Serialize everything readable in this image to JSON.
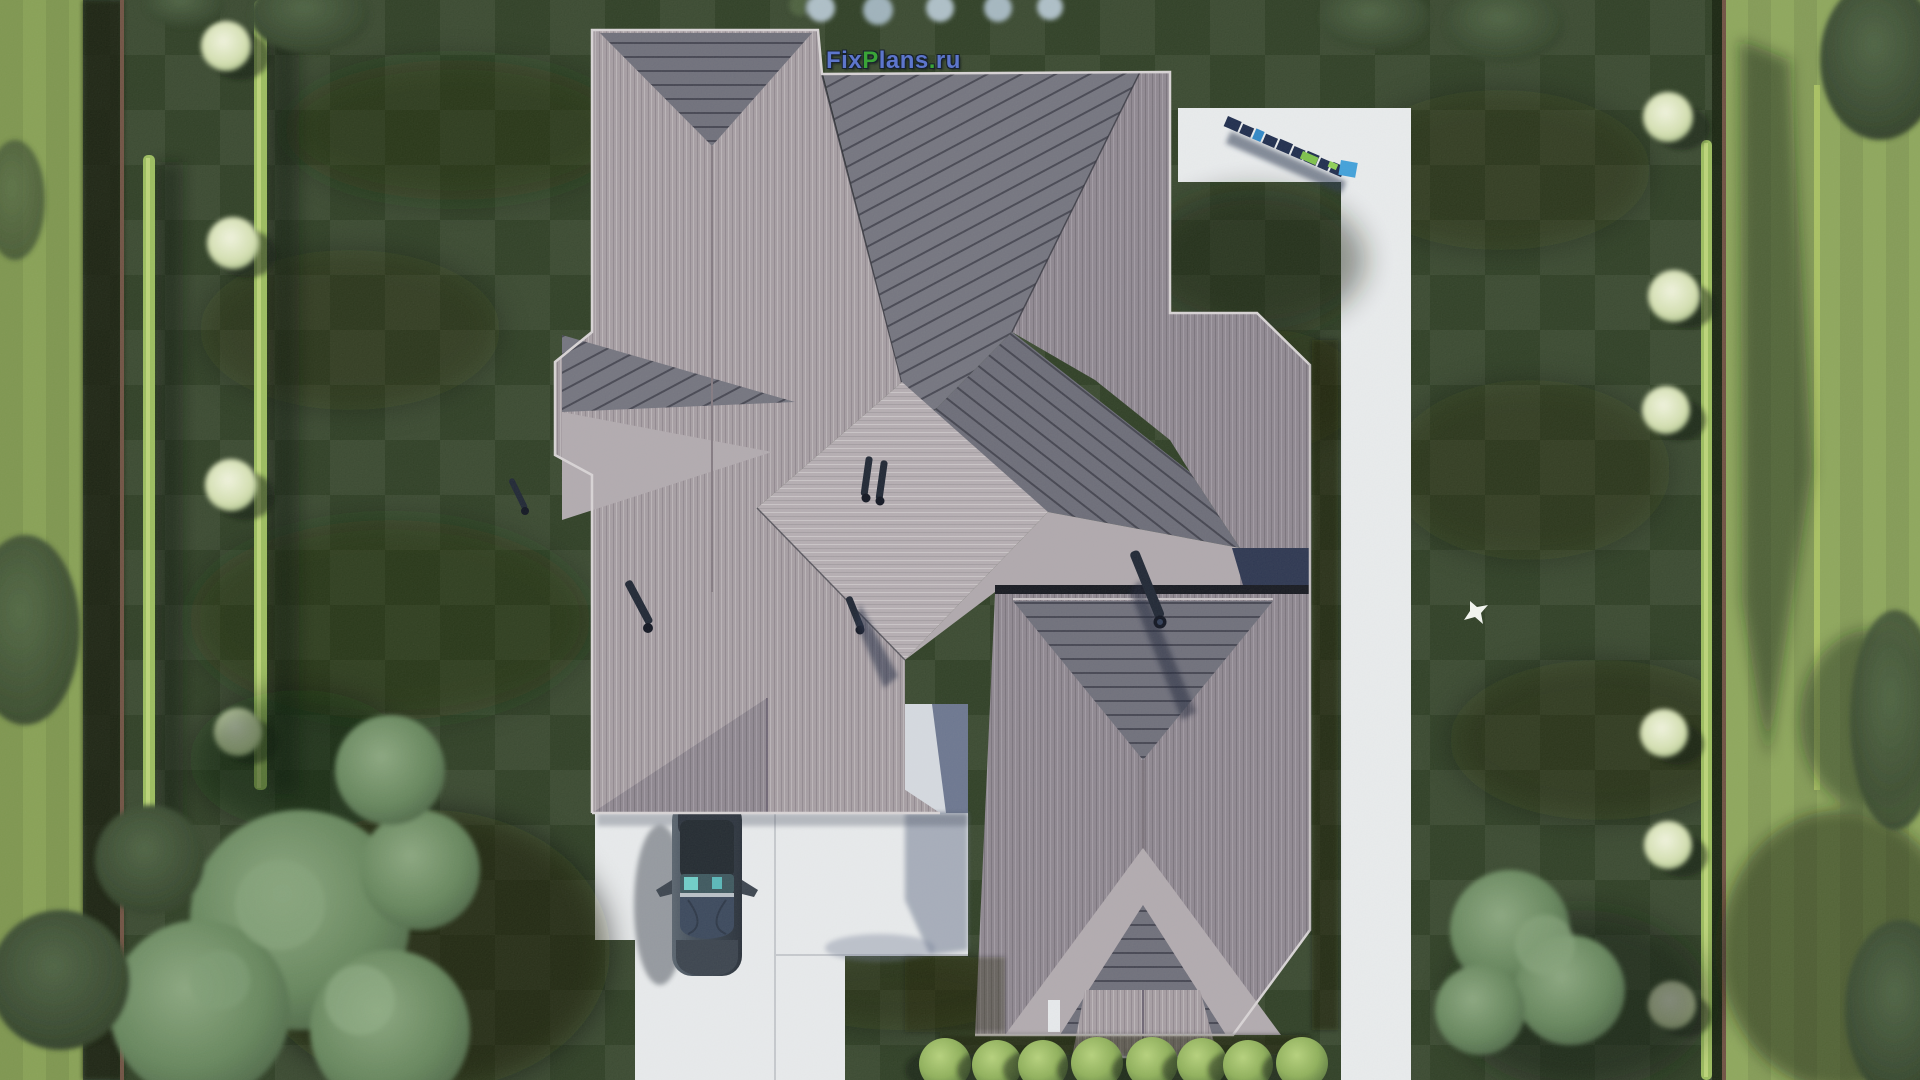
{
  "meta": {
    "type": "3d-aerial-architectural-render",
    "view": "top-down bird's-eye view of a house plot"
  },
  "watermark": {
    "parts": [
      {
        "text": "Fix",
        "color": "#5d76cc"
      },
      {
        "text": "P",
        "color": "#3aa437"
      },
      {
        "text": "lans",
        "color": "#5d76cc"
      },
      {
        "text": ".",
        "color": "#3aa437"
      },
      {
        "text": "ru",
        "color": "#5d76cc"
      }
    ],
    "outline_color": "#18222e"
  },
  "colors": {
    "lawn": "#2d3d24",
    "lawn_patch": "#16220f",
    "outer_strip_left": "#87a054",
    "outer_strip_right": "#8da65b",
    "hedge": "#9cbd5e",
    "fence": "#6f5042",
    "path": "#eaecef",
    "driveway": "#e9ebee",
    "courtyard_shadow": "#6b7590",
    "roof_light": "#a69da4",
    "roof_bright": "#b5adb3",
    "roof_medium": "#8e8691",
    "roof_dark": "#6e6e7b",
    "roof_fascia": "#d9d4d7",
    "roof_valley": "#2a2a36",
    "chimney": "#1d2433",
    "car_body": "#454f5e",
    "car_roof": "#20272f",
    "car_glass": "#66c4c4",
    "bush": "#9dbd63",
    "tree_canopy": "#5d7b55",
    "tree_white_top": "#eef2dd",
    "logo_block": "#1c2a4d",
    "logo_blue_cube": "#3fa0dc",
    "logo_green_bar": "#7dc14a",
    "bird": "#f4f6f2"
  },
  "scene": {
    "house": {
      "label": "gray hip-roof house seen from above",
      "sections": [
        "left wing with dark ridge triangle and garage gable",
        "top-right wing with diagonal-striped planes",
        "central bright hip cap with twin flue pipes",
        "bottom-right wing with striped triangle, chevron eaves and porch hip"
      ],
      "chimney_count": 5
    },
    "car": {
      "label": "dark SUV parked on driveway under garage eave",
      "heading": "south"
    },
    "walkway": {
      "label": "L-shaped white concrete walkway on the right",
      "logo_blocks_label": "row of 3D letter blocks with blue and green cubes casting shadows"
    },
    "driveway": {
      "label": "white concrete driveway and patio at bottom-left"
    },
    "landscape": {
      "bottom_bush_count": 8,
      "left_white_top_trees": 4,
      "right_white_top_trees": 6,
      "top_shrub_count": 5,
      "bird": "white bird flying over lawn right of house"
    }
  }
}
